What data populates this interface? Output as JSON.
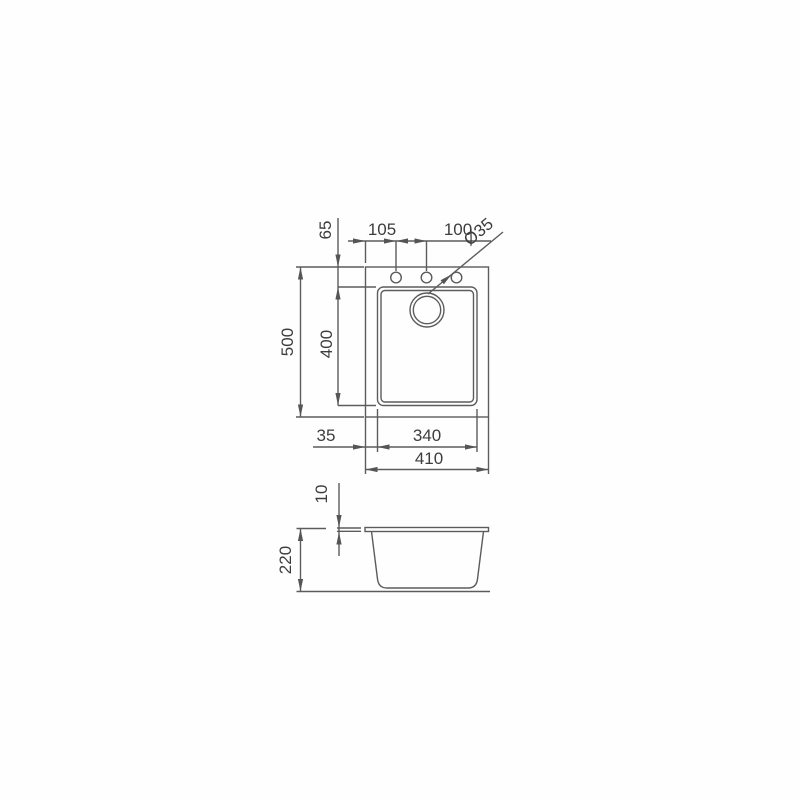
{
  "drawing": {
    "top_view": {
      "rim_to_bowl_top": "65",
      "hole_offset_left": "105",
      "hole_spacing": "100",
      "hole_diameter": "Ø35",
      "overall_depth": "500",
      "bowl_depth": "400",
      "rim_to_bowl_left": "35",
      "bowl_width": "340",
      "overall_width": "410"
    },
    "side_view": {
      "rim_thickness": "10",
      "bowl_height": "220"
    }
  }
}
